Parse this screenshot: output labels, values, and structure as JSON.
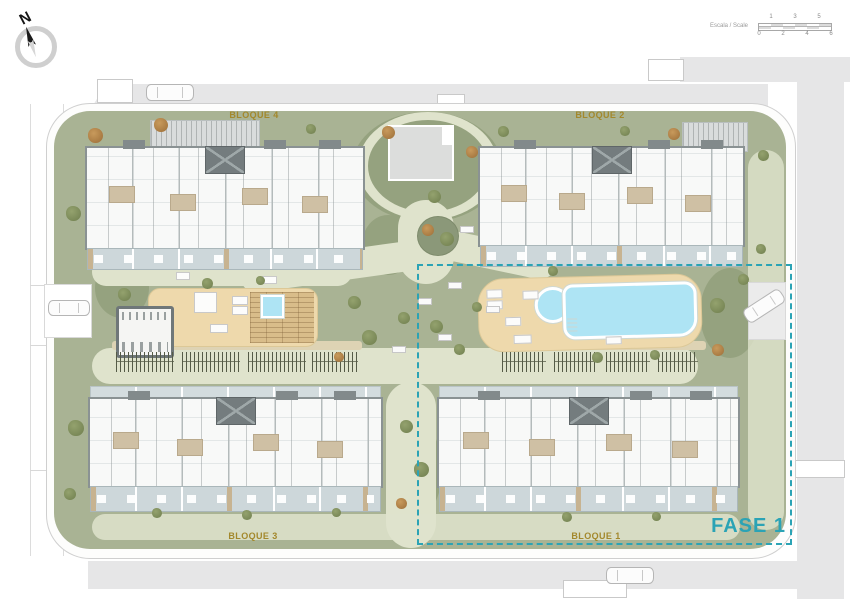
{
  "compass": {
    "north_label": "N"
  },
  "scale_bar": {
    "label": "Escala / Scale",
    "ticks_top": [
      "1",
      "3",
      "5"
    ],
    "ticks_bottom": [
      "0",
      "2",
      "4",
      "6"
    ]
  },
  "plan": {
    "block_labels": {
      "bloque4": "BLOQUE 4",
      "bloque2": "BLOQUE 2",
      "bloque3": "BLOQUE 3",
      "bloque1": "BLOQUE 1"
    },
    "phase_label": "FASE 1",
    "colors": {
      "garden_green": "#a9b394",
      "shrub_green": "#95a27f",
      "path": "#dfe3cc",
      "deck_sand": "#eed9ac",
      "pool_water": "#aee4f4",
      "road_grey": "#e6e6e7",
      "terrace_grey": "#cdd7da",
      "building_wall": "#8a9293",
      "phase_teal": "#2ba3b5",
      "label_olive": "#a3882c"
    }
  }
}
